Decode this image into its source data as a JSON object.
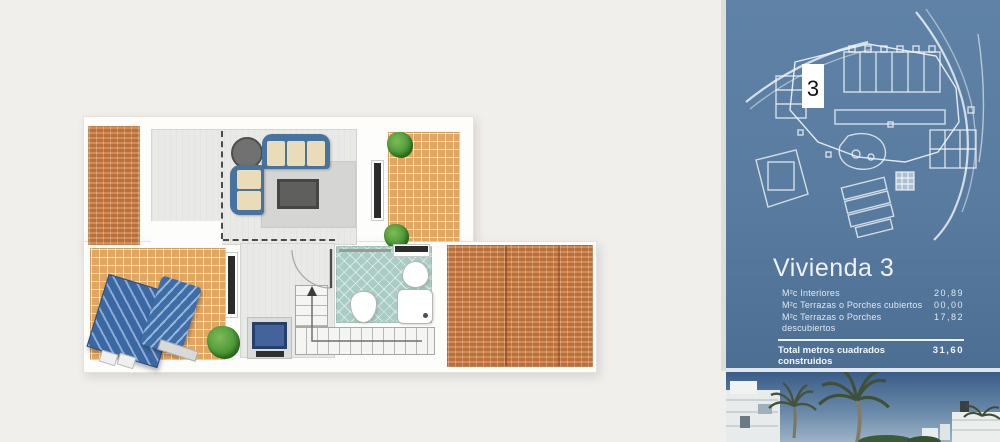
{
  "panel": {
    "title": "Vivienda 3",
    "unit_marker": "3",
    "rows": [
      {
        "label": "M²c Interiores",
        "value": "20,89"
      },
      {
        "label": "M²c Terrazas o Porches cubiertos",
        "value": "00,00"
      },
      {
        "label": "M²c Terrazas o Porches descubiertos",
        "value": "17,82"
      }
    ],
    "total": {
      "label": "Total metros cuadrados construidos",
      "value": "31,60"
    }
  },
  "colors": {
    "panel_blue_top": "#5f82a6",
    "panel_blue_bottom": "#4c6e92",
    "terrace_tile": "#e2a660",
    "roof_terracotta": "#c07a46",
    "bathroom_tile": "#a9ccc4",
    "sofa_blue": "#47739e",
    "page_background": "#f1efec"
  }
}
